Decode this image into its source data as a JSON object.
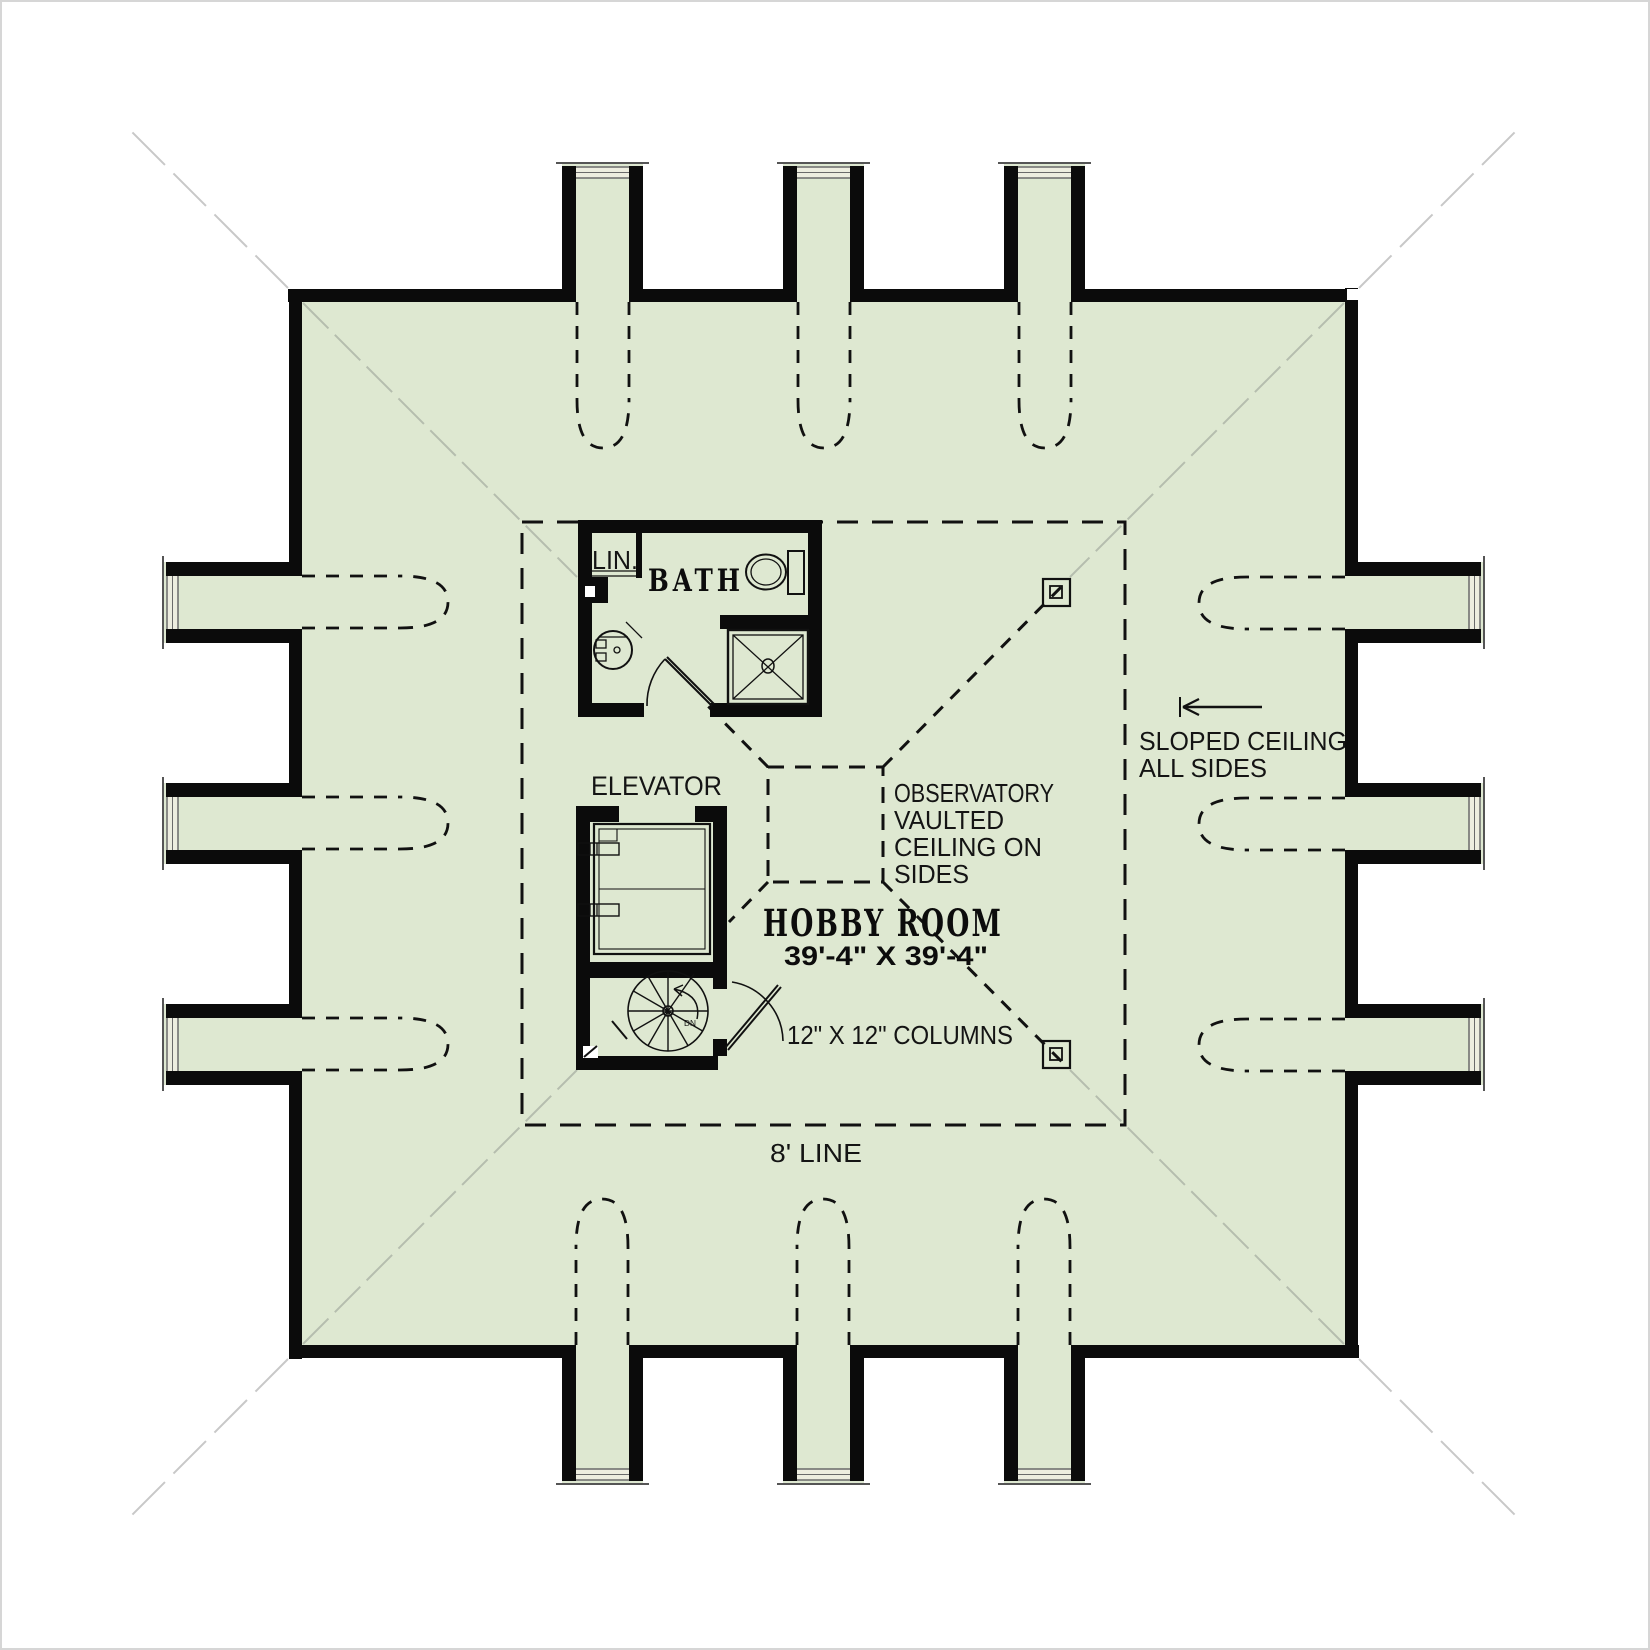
{
  "colors": {
    "floor": "#dee8d1",
    "glass": "#ededdf",
    "wall": "#0b0b0b",
    "hip_line": "#b5bdae",
    "dashed_line": "#111111"
  },
  "rooms": {
    "hobby": {
      "name": "HOBBY ROOM",
      "dims": "39'-4\" X 39'-4\""
    },
    "bath": {
      "name": "BATH"
    },
    "linen": {
      "name": "LIN."
    },
    "elevator": {
      "name": "ELEVATOR"
    }
  },
  "notes": {
    "observatory": [
      "OBSERVATORY",
      "VAULTED",
      "CEILING ON",
      "SIDES"
    ],
    "columns": "12\" X 12\" COLUMNS",
    "sloped": [
      "SLOPED CEILING",
      "ALL SIDES"
    ],
    "eight_line": "8' LINE",
    "stair": "DN"
  }
}
